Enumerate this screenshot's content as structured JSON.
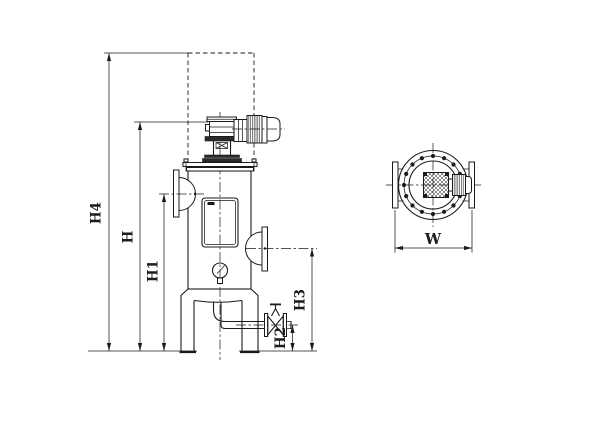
{
  "drawing": {
    "front_view": {
      "dimension_labels": {
        "h4": "H4",
        "h": "H",
        "h1": "H1",
        "h2": "H2",
        "h3": "H3"
      }
    },
    "top_view": {
      "dimension_labels": {
        "w": "W"
      }
    },
    "colors": {
      "line": "#1b1b1b",
      "background": "#ffffff"
    }
  }
}
